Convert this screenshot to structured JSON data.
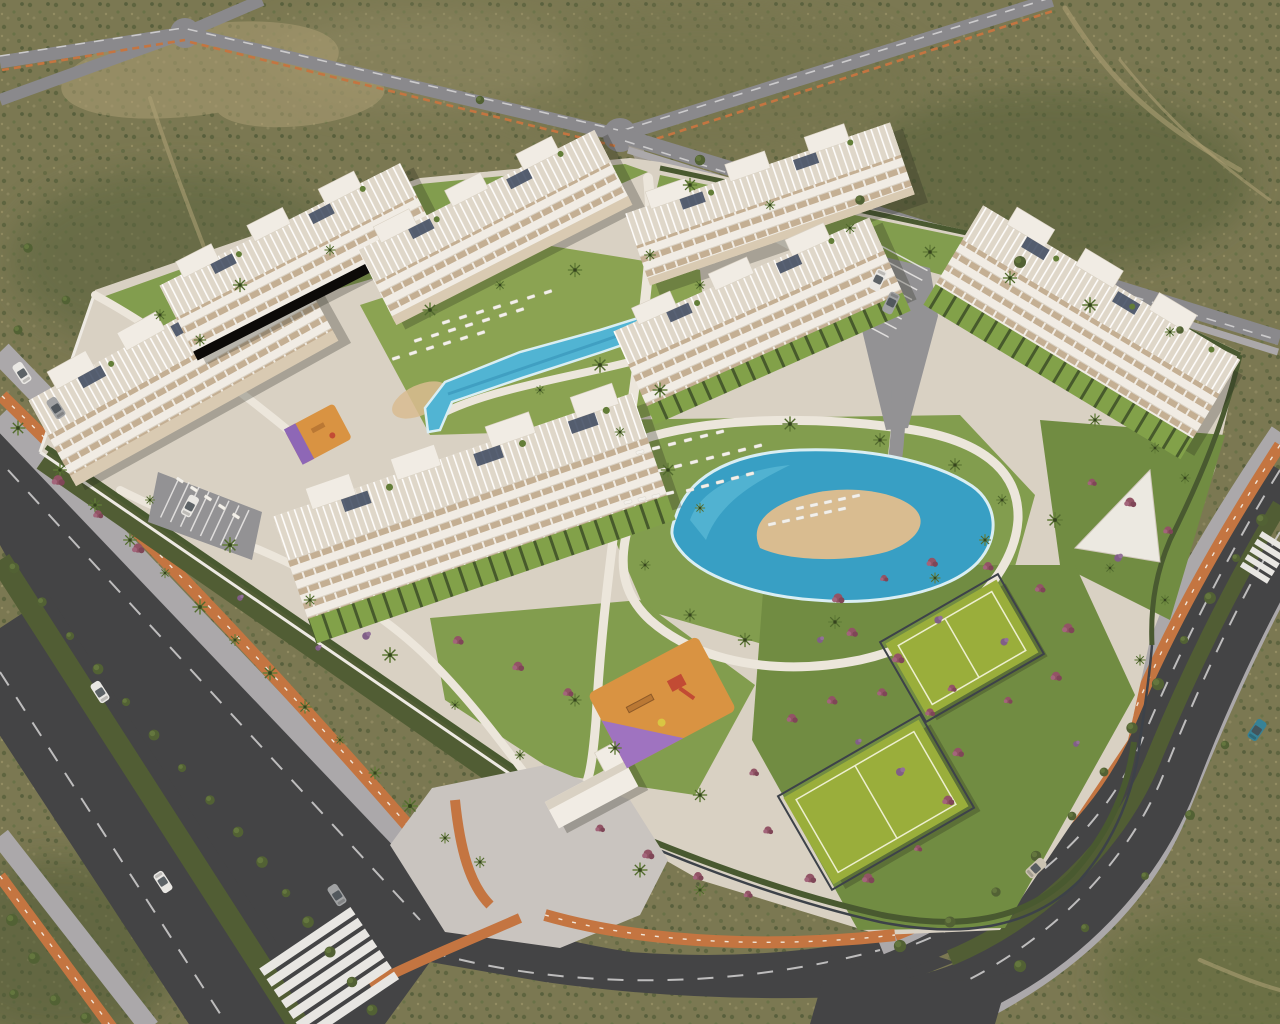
{
  "meta": {
    "title": "Aerial 3D render - gated residential resort complex in desert scrubland",
    "view": "aerial-oblique",
    "image_type": "architectural-visualization",
    "visible_text": ""
  },
  "palette": {
    "terrain": "#75744e",
    "terrainDark": "#4e5a35",
    "terrainLight": "#969067",
    "dirt": "#a99c72",
    "roadDark": "#3b3e41",
    "roadMid": "#85868c",
    "roadLight": "#9b9ca1",
    "sidewalk": "#a8a7ab",
    "paving": "#d8d2c6",
    "plaza": "#c8c4c1",
    "cycle": "#c2713d",
    "cycleDash": "#f3e8dc",
    "laneDash": "#d3d4d6",
    "median": "#49582f",
    "hedge": "#41542b",
    "lawn": "#7d9b4a",
    "lawnBright": "#86a24e",
    "lawnDark": "#6b8a3e",
    "pool": "#49b4d6",
    "poolDeep": "#2f9ec7",
    "poolRim": "#d8f1f8",
    "sand": "#d9bc90",
    "bldg": "#f2efe8",
    "bldgShade": "#d9d2c6",
    "roofBase": "#dfd9cc",
    "window": "#c2ae93",
    "terraceTan": "#d8cbb4",
    "solar": "#33415a",
    "wall": "#efede7",
    "court": "#96ad36",
    "courtLine": "#eef2d2",
    "fence": "#343c45",
    "playOrange": "#d8913e",
    "playPurple": "#9b6fc2",
    "playRed": "#c0452f",
    "playYellow": "#d9c63f",
    "palm": "#3f5526",
    "palmLight": "#5c7a33",
    "bush": "#4a5c2f",
    "shrubMagenta": "#8e4f63",
    "shrubPurple": "#7c5a86",
    "carWhite": "#e9e9e7",
    "carGray": "#9da1a4",
    "carSilver": "#c9c2b3",
    "carTeal": "#2e7f96",
    "carGlass": "#3c454d",
    "shadow": "rgba(30,32,22,0.28)"
  },
  "scene": {
    "terrain": {
      "description": "olive desert scrub with dirt trails",
      "color_key": "terrain"
    },
    "roads": [
      {
        "name": "southwest-boulevard",
        "lanes": 5,
        "features": [
          "hedge-median",
          "orange-cycle-paths-both-sides",
          "zebra-crosswalk",
          "palm-lined-verge"
        ]
      },
      {
        "name": "east-ring-road",
        "lanes": 4,
        "features": [
          "hedge-median",
          "orange-cycle-path",
          "curved-corner",
          "small-crosswalk"
        ]
      },
      {
        "name": "north-crossroad",
        "lanes": 2,
        "features": [
          "x-intersection",
          "orange-cycle-dashes"
        ]
      },
      {
        "name": "northeast-avenue",
        "lanes": 2,
        "features": [
          "y-junction",
          "orange-cycle-dashes"
        ]
      },
      {
        "name": "northeast-boundary-road",
        "lanes": 2,
        "features": [
          "white-dashes"
        ]
      }
    ],
    "buildings": [
      {
        "id": "B1",
        "floors": 4,
        "style": "white terraced apartment block",
        "transform": "translate(182 368) rotate(-29)"
      },
      {
        "id": "B2",
        "floors": 4,
        "style": "white terraced apartment block",
        "transform": "translate(298 260) rotate(-27)"
      },
      {
        "id": "B3",
        "floors": 4,
        "style": "white terraced apartment block",
        "transform": "translate(494 226) rotate(-27)"
      },
      {
        "id": "B4",
        "floors": 4,
        "style": "white terraced apartment block",
        "transform": "translate(770 204) rotate(-19)"
      },
      {
        "id": "B5",
        "floors": 4,
        "style": "white terraced apartment block",
        "transform": "translate(758 312) rotate(-24)"
      },
      {
        "id": "B6",
        "floors": 4,
        "style": "white terraced apartment block",
        "transform": "translate(1088 322) rotate(31)"
      },
      {
        "id": "B7",
        "floors": 4,
        "style": "white terraced apartment block",
        "transform": "translate(470 506) rotate(-19)"
      }
    ],
    "amenities": [
      {
        "name": "main-lagoon-pool",
        "type": "pool",
        "feature": "free-form with central sand beach island"
      },
      {
        "name": "upper-lap-pool",
        "type": "pool",
        "feature": "elongated with sun loungers on lawn"
      },
      {
        "name": "tennis-court-north",
        "type": "sport-court"
      },
      {
        "name": "tennis-court-south",
        "type": "sport-court"
      },
      {
        "name": "central-playground",
        "type": "playground",
        "surface": "orange-purple rubber"
      },
      {
        "name": "west-playground",
        "type": "playground",
        "surface": "orange-purple rubber"
      },
      {
        "name": "white-solarium-deck",
        "type": "deck"
      },
      {
        "name": "entrance-gatehouse",
        "type": "building"
      },
      {
        "name": "east-parking",
        "type": "parking"
      },
      {
        "name": "west-parking",
        "type": "parking"
      },
      {
        "name": "north-parking-bay",
        "type": "parking"
      }
    ],
    "vehicles": [
      {
        "type": "car",
        "x": 100,
        "y": 692,
        "a": 57,
        "c": "carWhite"
      },
      {
        "type": "car",
        "x": 163,
        "y": 882,
        "a": 237,
        "c": "carWhite"
      },
      {
        "type": "car",
        "x": 337,
        "y": 895,
        "a": 57,
        "c": "carGray"
      },
      {
        "type": "car",
        "x": 1036,
        "y": 868,
        "a": 137,
        "c": "carSilver"
      },
      {
        "type": "car",
        "x": 1257,
        "y": 730,
        "a": 124,
        "c": "carTeal"
      },
      {
        "type": "car",
        "x": 22,
        "y": 373,
        "a": 57,
        "c": "carWhite"
      },
      {
        "type": "car",
        "x": 56,
        "y": 408,
        "a": 57,
        "c": "carGray"
      },
      {
        "type": "car",
        "x": 878,
        "y": 280,
        "a": -64,
        "c": "carWhite"
      },
      {
        "type": "car",
        "x": 891,
        "y": 303,
        "a": -64,
        "c": "carGray"
      },
      {
        "type": "car",
        "x": 190,
        "y": 506,
        "a": 118,
        "c": "carWhite"
      }
    ],
    "loungers": [
      {
        "x": 396,
        "y": 358,
        "n": 6,
        "dx": 17,
        "dy": -5,
        "a": -18
      },
      {
        "x": 418,
        "y": 340,
        "n": 7,
        "dx": 17,
        "dy": -5,
        "a": -18
      },
      {
        "x": 446,
        "y": 322,
        "n": 7,
        "dx": 17,
        "dy": -5,
        "a": -18
      },
      {
        "x": 180,
        "y": 480,
        "n": 5,
        "dx": 14,
        "dy": 9,
        "a": 33
      },
      {
        "x": 640,
        "y": 452,
        "n": 6,
        "dx": 16,
        "dy": -4,
        "a": -14
      },
      {
        "x": 662,
        "y": 470,
        "n": 7,
        "dx": 16,
        "dy": -4,
        "a": -14
      },
      {
        "x": 690,
        "y": 490,
        "n": 5,
        "dx": 15,
        "dy": -4,
        "a": -14
      },
      {
        "x": 772,
        "y": 524,
        "n": 6,
        "dx": 14,
        "dy": -3,
        "a": -13
      },
      {
        "x": 800,
        "y": 508,
        "n": 5,
        "dx": 14,
        "dy": -3,
        "a": -13
      },
      {
        "x": 628,
        "y": 502,
        "n": 4,
        "dx": 14,
        "dy": -3,
        "a": -13
      }
    ],
    "plants": [
      [
        60,
        470,
        "p"
      ],
      [
        95,
        505,
        "p"
      ],
      [
        130,
        540,
        "p"
      ],
      [
        165,
        573,
        "p"
      ],
      [
        200,
        607,
        "p"
      ],
      [
        235,
        640,
        "p"
      ],
      [
        270,
        673,
        "p"
      ],
      [
        305,
        707,
        "p"
      ],
      [
        340,
        740,
        "p"
      ],
      [
        375,
        773,
        "p"
      ],
      [
        410,
        806,
        "p"
      ],
      [
        445,
        838,
        "p"
      ],
      [
        480,
        862,
        "p"
      ],
      [
        18,
        428,
        "p"
      ],
      [
        150,
        500,
        "p"
      ],
      [
        230,
        545,
        "p"
      ],
      [
        310,
        600,
        "p"
      ],
      [
        390,
        655,
        "p"
      ],
      [
        455,
        705,
        "p"
      ],
      [
        520,
        755,
        "p"
      ],
      [
        430,
        310,
        "p"
      ],
      [
        500,
        285,
        "p"
      ],
      [
        575,
        270,
        "p"
      ],
      [
        650,
        255,
        "p"
      ],
      [
        700,
        285,
        "p"
      ],
      [
        600,
        365,
        "p"
      ],
      [
        540,
        390,
        "p"
      ],
      [
        660,
        390,
        "p"
      ],
      [
        160,
        315,
        "p"
      ],
      [
        240,
        285,
        "p"
      ],
      [
        330,
        250,
        "p"
      ],
      [
        200,
        340,
        "p"
      ],
      [
        690,
        185,
        "p"
      ],
      [
        770,
        205,
        "p"
      ],
      [
        850,
        228,
        "p"
      ],
      [
        930,
        252,
        "p"
      ],
      [
        1010,
        278,
        "p"
      ],
      [
        1090,
        305,
        "p"
      ],
      [
        1170,
        332,
        "p"
      ],
      [
        620,
        432,
        "p"
      ],
      [
        668,
        470,
        "p"
      ],
      [
        700,
        508,
        "p"
      ],
      [
        645,
        565,
        "p"
      ],
      [
        690,
        615,
        "p"
      ],
      [
        745,
        640,
        "p"
      ],
      [
        835,
        622,
        "p"
      ],
      [
        935,
        578,
        "p"
      ],
      [
        985,
        540,
        "p"
      ],
      [
        1002,
        500,
        "p"
      ],
      [
        955,
        465,
        "p"
      ],
      [
        880,
        440,
        "p"
      ],
      [
        790,
        424,
        "p"
      ],
      [
        575,
        700,
        "p"
      ],
      [
        615,
        748,
        "p"
      ],
      [
        700,
        795,
        "p"
      ],
      [
        640,
        870,
        "p"
      ],
      [
        700,
        890,
        "p"
      ],
      [
        1095,
        420,
        "p"
      ],
      [
        1155,
        448,
        "p"
      ],
      [
        1185,
        478,
        "p"
      ],
      [
        1055,
        520,
        "p"
      ],
      [
        1110,
        568,
        "p"
      ],
      [
        1165,
        600,
        "p"
      ],
      [
        1140,
        660,
        "p"
      ],
      [
        14,
        568,
        "b"
      ],
      [
        42,
        602,
        "b"
      ],
      [
        70,
        636,
        "b"
      ],
      [
        98,
        669,
        "b"
      ],
      [
        126,
        702,
        "b"
      ],
      [
        154,
        735,
        "b"
      ],
      [
        182,
        768,
        "b"
      ],
      [
        210,
        800,
        "b"
      ],
      [
        238,
        832,
        "b"
      ],
      [
        262,
        862,
        "b"
      ],
      [
        286,
        893,
        "b"
      ],
      [
        308,
        922,
        "b"
      ],
      [
        330,
        952,
        "b"
      ],
      [
        352,
        982,
        "b"
      ],
      [
        372,
        1010,
        "b"
      ],
      [
        1262,
        520,
        "b"
      ],
      [
        1236,
        558,
        "b"
      ],
      [
        1210,
        598,
        "b"
      ],
      [
        1184,
        640,
        "b"
      ],
      [
        1158,
        684,
        "b"
      ],
      [
        1132,
        728,
        "b"
      ],
      [
        1104,
        772,
        "b"
      ],
      [
        1072,
        816,
        "b"
      ],
      [
        1036,
        856,
        "b"
      ],
      [
        996,
        892,
        "b"
      ],
      [
        950,
        922,
        "b"
      ],
      [
        900,
        946,
        "b"
      ],
      [
        700,
        160,
        "b"
      ],
      [
        860,
        200,
        "b"
      ],
      [
        1020,
        262,
        "b"
      ],
      [
        1180,
        330,
        "b"
      ],
      [
        480,
        100,
        "b"
      ],
      [
        12,
        920,
        "b"
      ],
      [
        34,
        958,
        "b"
      ],
      [
        14,
        994,
        "b"
      ],
      [
        55,
        1000,
        "b"
      ],
      [
        86,
        1018,
        "b"
      ],
      [
        1225,
        745,
        "b"
      ],
      [
        1190,
        815,
        "b"
      ],
      [
        1145,
        876,
        "b"
      ],
      [
        1085,
        928,
        "b"
      ],
      [
        1020,
        966,
        "b"
      ],
      [
        28,
        248,
        "b"
      ],
      [
        66,
        300,
        "b"
      ],
      [
        18,
        330,
        "b"
      ],
      [
        838,
        598,
        "m"
      ],
      [
        884,
        578,
        "m"
      ],
      [
        932,
        562,
        "m"
      ],
      [
        988,
        566,
        "m"
      ],
      [
        1040,
        588,
        "m"
      ],
      [
        1068,
        628,
        "m"
      ],
      [
        1056,
        676,
        "m"
      ],
      [
        1008,
        700,
        "m"
      ],
      [
        952,
        688,
        "m"
      ],
      [
        898,
        658,
        "m"
      ],
      [
        852,
        632,
        "m"
      ],
      [
        792,
        718,
        "m"
      ],
      [
        832,
        700,
        "m"
      ],
      [
        882,
        692,
        "m"
      ],
      [
        930,
        712,
        "m"
      ],
      [
        958,
        752,
        "m"
      ],
      [
        948,
        800,
        "m"
      ],
      [
        918,
        848,
        "m"
      ],
      [
        868,
        878,
        "m"
      ],
      [
        810,
        878,
        "m"
      ],
      [
        768,
        830,
        "m"
      ],
      [
        754,
        772,
        "m"
      ],
      [
        1092,
        482,
        "m"
      ],
      [
        1130,
        502,
        "m"
      ],
      [
        1168,
        530,
        "m"
      ],
      [
        600,
        828,
        "m"
      ],
      [
        648,
        854,
        "m"
      ],
      [
        698,
        876,
        "m"
      ],
      [
        748,
        894,
        "m"
      ],
      [
        458,
        640,
        "m"
      ],
      [
        518,
        666,
        "m"
      ],
      [
        568,
        692,
        "m"
      ],
      [
        58,
        480,
        "m"
      ],
      [
        98,
        514,
        "m"
      ],
      [
        138,
        548,
        "m"
      ],
      [
        820,
        640,
        "v"
      ],
      [
        938,
        620,
        "v"
      ],
      [
        1004,
        642,
        "v"
      ],
      [
        858,
        742,
        "v"
      ],
      [
        900,
        772,
        "v"
      ],
      [
        1118,
        558,
        "v"
      ],
      [
        240,
        598,
        "v"
      ],
      [
        318,
        648,
        "v"
      ],
      [
        1076,
        744,
        "v"
      ],
      [
        366,
        636,
        "v"
      ]
    ],
    "crosswalks": [
      {
        "name": "boulevard-zebra-crossing",
        "stripes": 7
      },
      {
        "name": "east-road-zebra-crossing",
        "stripes": 5
      }
    ]
  }
}
